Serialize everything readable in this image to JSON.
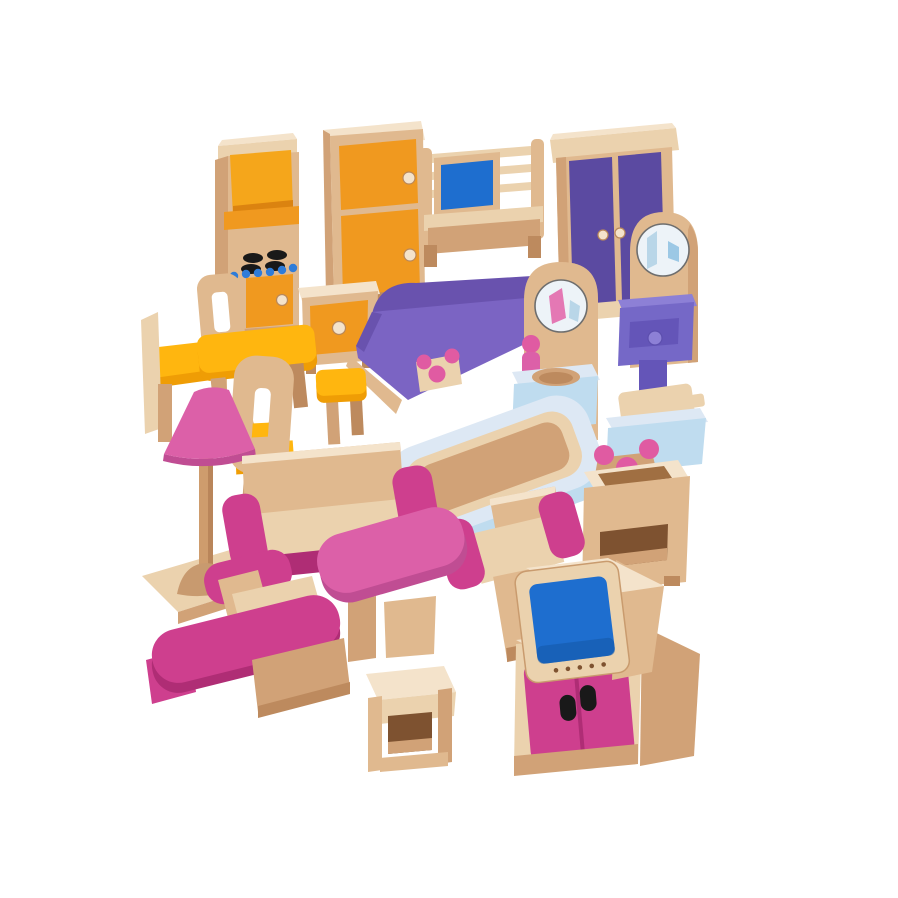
{
  "scene": {
    "description": "Product photo of a wooden dolls house furniture set: 23 painted beech-wood miniature pieces (kitchen, bedroom, bathroom and living room) arranged in a group on a plain white background",
    "background": "#FFFFFF"
  },
  "palette": {
    "background": "#FFFFFF",
    "wood-pale": "#F4E3CB",
    "wood-light": "#EBD2AE",
    "wood": "#E0B98F",
    "wood-mid": "#D1A277",
    "wood-dark": "#BD8A5E",
    "wood-deep": "#A06F42",
    "cavity": "#7E5230",
    "amber": "#F5A61B",
    "orange": "#F0991F",
    "orange-dark": "#DB8310",
    "yellow": "#FFB60F",
    "yellow-dark": "#EF9D05",
    "purple-dark": "#5B4AA1",
    "purple": "#7B64C3",
    "purple-mid": "#6952AE",
    "drawer": "#7568C7",
    "drawer-light": "#8D80D6",
    "drawer-dark": "#6455B8",
    "screen": "#1E6ECF",
    "screen-dark": "#1457A6",
    "light-blue": "#BFDCEF",
    "pale-blue": "#DDE8F4",
    "mid-blue": "#9CC8E5",
    "magenta": "#CE3F8E",
    "magenta-dark": "#AF2D75",
    "pink": "#DC60A8",
    "pink-dark": "#C04D93",
    "knob-pink": "#E05BA2",
    "dot-blue": "#2F7CD8",
    "black": "#191919",
    "mirror": "#EDF3F8",
    "mirror-blue": "#B9D6E8",
    "mirror-pink": "#E478B4",
    "white": "#FFFFFF"
  },
  "items": [
    {
      "id": "cooker",
      "name": "Kitchen cooker with hob and oven"
    },
    {
      "id": "fridge",
      "name": "Fridge with two orange doors"
    },
    {
      "id": "cot",
      "name": "Baby cot with rails and blue panel"
    },
    {
      "id": "wardrobe",
      "name": "Purple double-door wardrobe"
    },
    {
      "id": "dressing-table",
      "name": "Dressing table with round mirror and purple drawer"
    },
    {
      "id": "kitchen-cabinet",
      "name": "Kitchen cabinet with orange drawer"
    },
    {
      "id": "dining-chair-left",
      "name": "Dining chair with yellow seat (left)"
    },
    {
      "id": "bed",
      "name": "Double bed with purple blanket"
    },
    {
      "id": "washstand",
      "name": "Washstand with round mirror and blue basin"
    },
    {
      "id": "dining-table",
      "name": "Yellow dining table"
    },
    {
      "id": "dining-chair-right",
      "name": "Dining chair with yellow seat (right)"
    },
    {
      "id": "stool-yellow",
      "name": "Yellow kitchen stool"
    },
    {
      "id": "toilet",
      "name": "Toilet with raised wooden lid"
    },
    {
      "id": "bathtub",
      "name": "Bathtub with wooden interior"
    },
    {
      "id": "washbasin",
      "name": "Washbasin stand with pink taps"
    },
    {
      "id": "floor-lamp",
      "name": "Floor lamp with pink shade"
    },
    {
      "id": "sofa",
      "name": "Sofa with pink armrests"
    },
    {
      "id": "armchair-right",
      "name": "Armchair with pink armrests (right)"
    },
    {
      "id": "coffee-table",
      "name": "Pink coffee table"
    },
    {
      "id": "armchair-left",
      "name": "Armchair with pink armrests (left)"
    },
    {
      "id": "tv-cabinet",
      "name": "TV cabinet with pink doors"
    },
    {
      "id": "tv",
      "name": "Television with blue screen"
    },
    {
      "id": "side-stool",
      "name": "Wooden side stool"
    }
  ]
}
